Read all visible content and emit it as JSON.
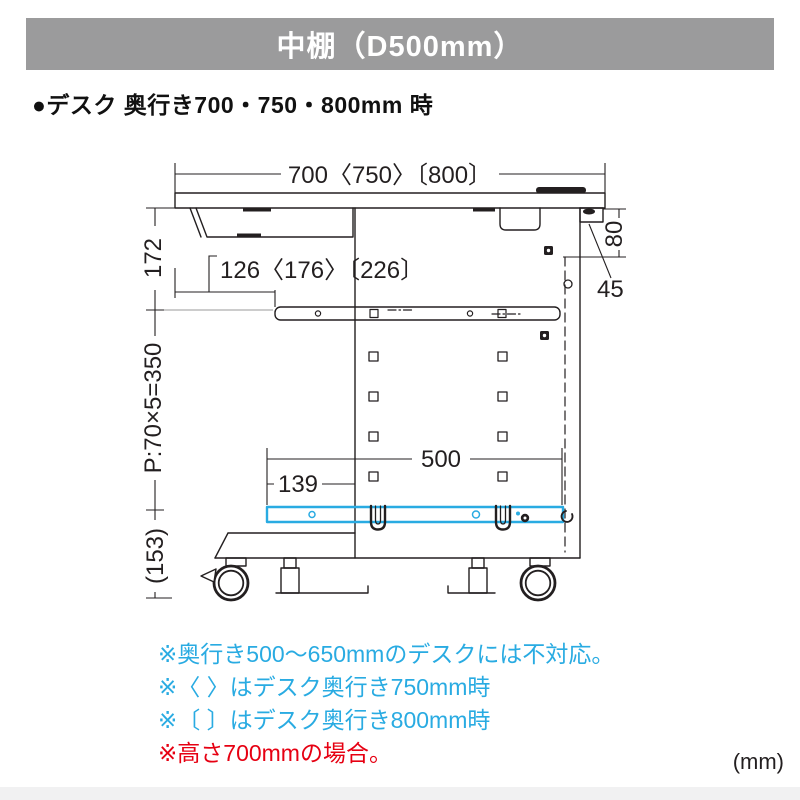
{
  "header": {
    "title": "中棚（D500mm）"
  },
  "section": {
    "heading": "●デスク 奥行き700・750・800mm 時"
  },
  "diagram": {
    "dims": {
      "top_width": "700〈750〉〔800〕",
      "under_top": "172",
      "front_inset": "126〈176〉〔226〕",
      "hole_pitch": "P:70×5=350",
      "shelf_depth": "500",
      "shelf_front_offset": "139",
      "rear_height": "80",
      "rear_overhang": "45",
      "floor_clearance": "(153)"
    }
  },
  "notes": [
    {
      "text": "※奥行き500〜650mmのデスクには不対応。",
      "color": "#29abe2"
    },
    {
      "text": "※〈 〉はデスク奥行き750mm時",
      "color": "#29abe2"
    },
    {
      "text": "※〔 〕はデスク奥行き800mm時",
      "color": "#29abe2"
    },
    {
      "text": "※高さ700mmの場合。",
      "color": "#e60012"
    }
  ],
  "unit_label": "(mm)",
  "colors": {
    "header_bar": "#9b9b9c",
    "shelf_highlight": "#29abe2",
    "note_blue": "#29abe2",
    "note_red": "#e60012",
    "line": "#231f20"
  }
}
